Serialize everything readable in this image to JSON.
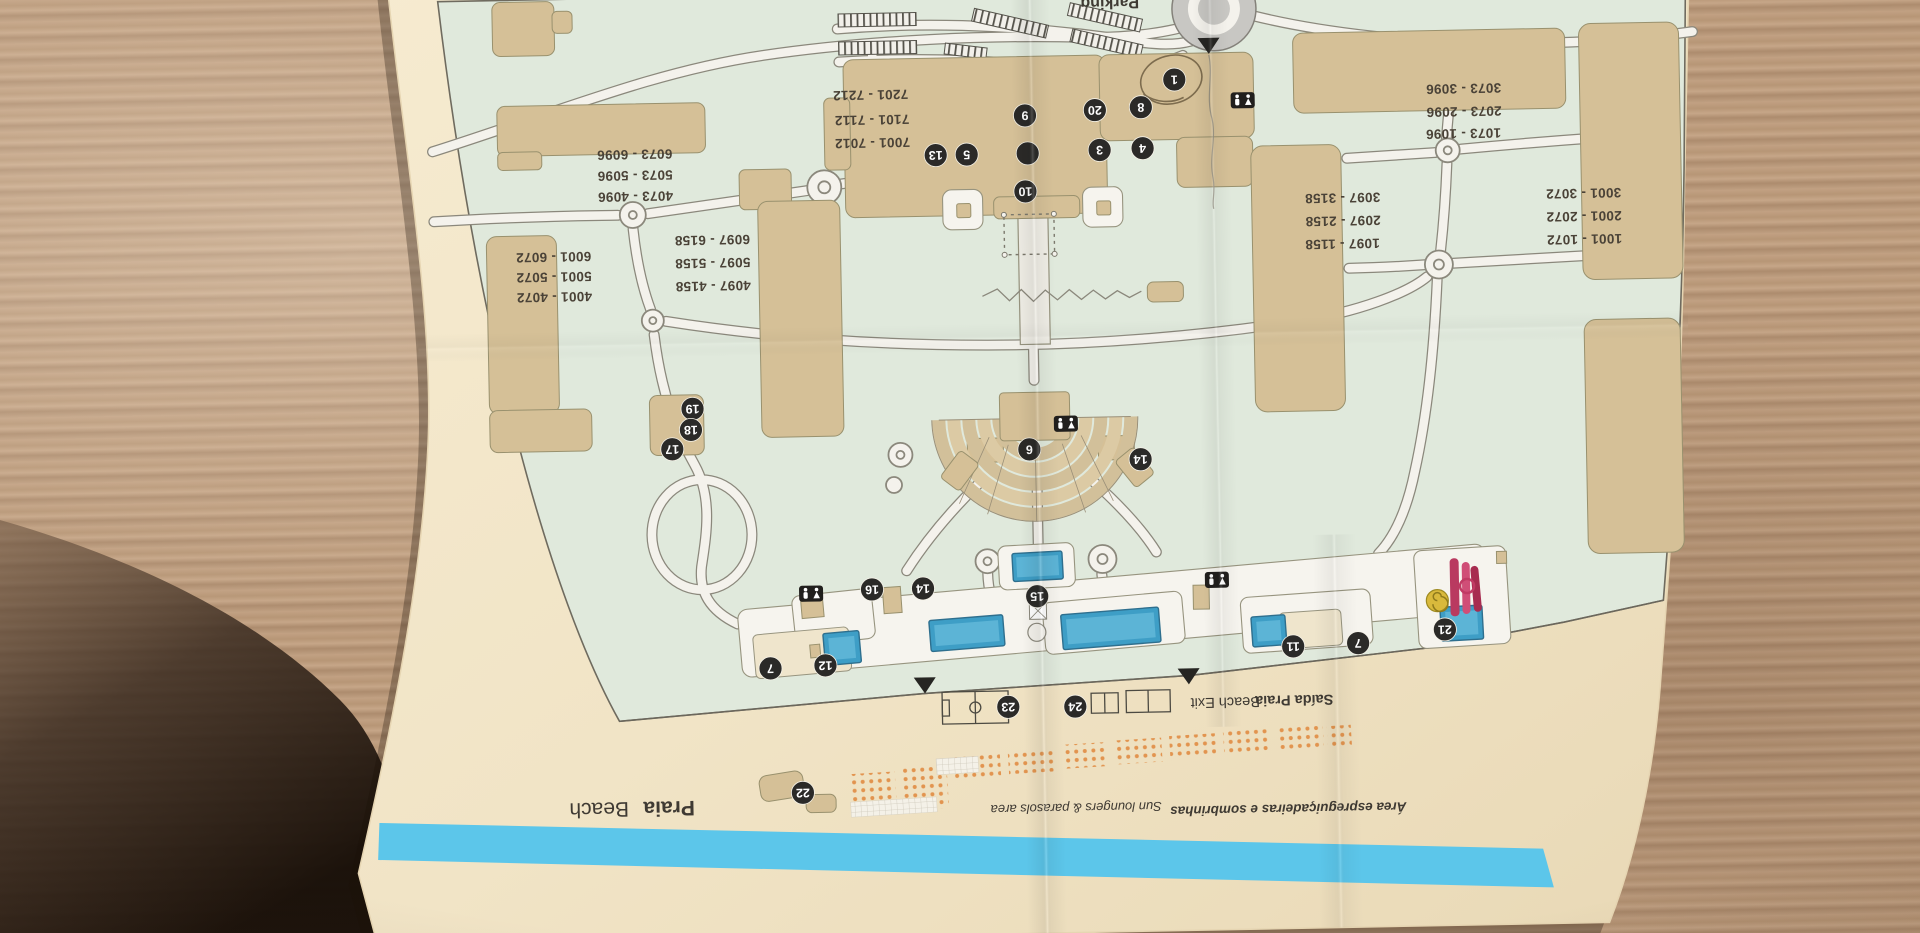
{
  "scene": {
    "description": "Paper resort site map photographed upside-down on a wooden table"
  },
  "labels": {
    "parking": "Parking",
    "beach_exit_pt": "Saída Praia",
    "beach_exit_en": "Beach Exit",
    "beach_pt": "Praia",
    "beach_en": "Beach",
    "loungers_pt": "Área espreguiçadeiras e sombrinhas",
    "loungers_en": "Sun loungers & parasols area"
  },
  "rooms": {
    "main_building": [
      "7201 - 7212",
      "7101 - 7112",
      "7001 - 7012"
    ],
    "west_upper": [
      "6073 - 6096",
      "5073 - 5096",
      "4073 - 4096"
    ],
    "west_mid": [
      "6097 - 6158",
      "5097 - 5158",
      "4097 - 4158"
    ],
    "west_lower": [
      "6001 - 6072",
      "5001 - 5072",
      "4001 - 4072"
    ],
    "east_upper": [
      "3073 - 3096",
      "2073 - 2096",
      "1073 - 1096"
    ],
    "east_mid": [
      "3097 - 3158",
      "2097 - 2158",
      "1097 - 1158"
    ],
    "east_lower": [
      "3001 - 3072",
      "2001 - 2072",
      "1001 - 1072"
    ]
  },
  "markers": {
    "m1": "1",
    "m2": "2",
    "m3": "3",
    "m4": "4",
    "m5": "5",
    "m6": "6",
    "m7": "7",
    "m8": "8",
    "m9": "9",
    "m10": "10",
    "m11": "11",
    "m12": "12",
    "m13": "13",
    "m14": "14",
    "m15": "15",
    "m16": "16",
    "m17": "17",
    "m18": "18",
    "m19": "19",
    "m20": "20",
    "m21": "21",
    "m22": "22",
    "m23": "23",
    "m24": "24"
  },
  "icons": [
    "wc-restroom-icon",
    "entrance-arrow-icon",
    "football-pitch-icon",
    "volleyball-court-icon",
    "sun-lounger-dots",
    "waterslide-icon",
    "lazy-spiral-pool-icon",
    "roundabout",
    "parking-stripes",
    "amphitheatre"
  ],
  "colors": {
    "paper": "#f3e7ca",
    "map_green": "#e0e9dc",
    "building_tan": "#d5c097",
    "pool_blue": "#3e9ec6",
    "sea_blue": "#5cc6ea",
    "marker_black": "#2b2a28",
    "lounger_orange": "#e2944f",
    "wood": "#b5947a",
    "road": "#f4f2ec"
  }
}
